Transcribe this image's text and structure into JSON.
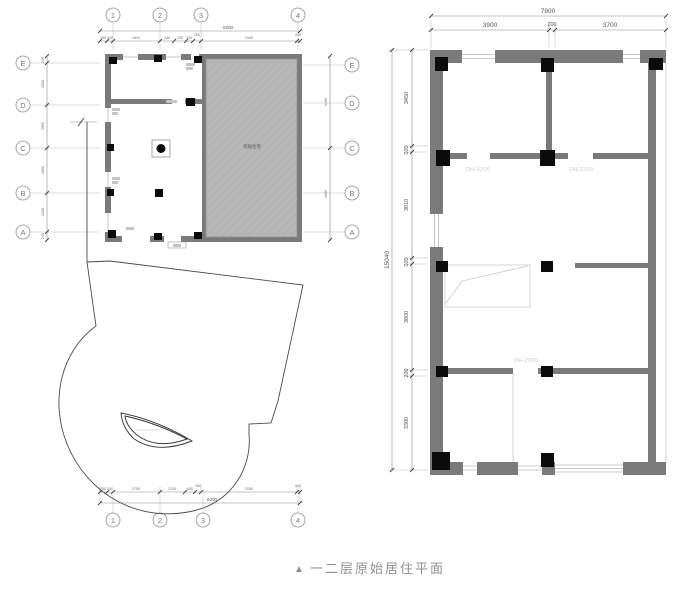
{
  "caption": {
    "marker": "▲",
    "text": "一二层原始居住平面"
  },
  "colors": {
    "wall": "#7a7a7a",
    "hatch_fill": "#b7b7b7",
    "column": "#0b0b0b",
    "dim_text": "#555555",
    "door_label": "#c9c9c9",
    "caption": "#8f8f8f"
  },
  "left_plan": {
    "col_bubbles": [
      "1",
      "2",
      "3",
      "4"
    ],
    "row_bubbles": [
      "E",
      "D",
      "C",
      "B",
      "A"
    ],
    "top_dims": {
      "total": "6200",
      "segments": [
        "150",
        "240",
        "1610",
        "240",
        "730",
        "240",
        "200",
        "3150",
        "240"
      ]
    },
    "bottom_dims": {
      "total": "6200",
      "segments": [
        "150",
        "240",
        "1750",
        "2130",
        "630",
        "160",
        "3150",
        "240"
      ]
    },
    "left_dims": {
      "segments": [
        "240",
        "1500",
        "1500",
        "1600",
        "1300",
        "240"
      ]
    },
    "right_dims": {
      "segments": [
        "3450",
        "3450"
      ]
    },
    "hatch_label": "邻居住宅"
  },
  "right_plan": {
    "top_dims": {
      "total": "7800",
      "segments": [
        "3900",
        "200",
        "3700"
      ]
    },
    "left_dims": {
      "total": "15040",
      "segments": [
        "3450",
        "200",
        "3810",
        "200",
        "3800",
        "200",
        "3380"
      ]
    },
    "door_labels": [
      "DH-2200",
      "DH-2200",
      "DH-2200"
    ]
  }
}
